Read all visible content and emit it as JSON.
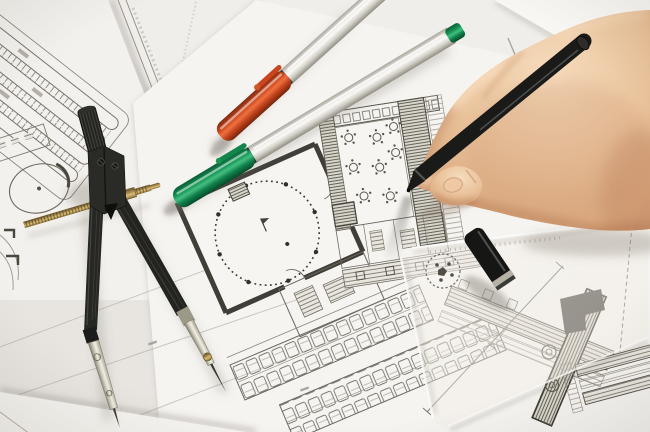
{
  "meta": {
    "domain": "photograph",
    "description": "Close-up photo of a hand drawing with a black pen on architectural floor plans; a drafting compass, an orange-capped and a green-capped marker pen, a black pen cap and a transparent set square lie on the drawings."
  },
  "objects": {
    "papers": {
      "label": "Stack of architectural drawings on white paper",
      "base_color": "#e8e5e1",
      "sheet_colors": [
        "#f0eeea",
        "#f3f1ed",
        "#f6f4f1",
        "#f8f7f4"
      ],
      "line_color": "#57544c",
      "wall_color": "#413e38"
    },
    "site_plan": {
      "label": "Site plan with rows of parking stalls (top left)"
    },
    "floor_plan": {
      "label": "Floor plan with dotted round hall, table seating area, hatched walls and parking rows"
    },
    "compass": {
      "label": "Drafting compass with knurled handle and brass adjusting screw",
      "body_color": "#262624",
      "metal_color": "#d8d5c6",
      "brass_color": "#b89a58"
    },
    "orange_pen": {
      "label": "Silver marker pen with orange cap",
      "cap_color": "#d34e22",
      "body_color": "#e9e7e1"
    },
    "green_pen": {
      "label": "Silver marker pen with green cap and green end plug",
      "cap_color": "#189a58",
      "body_color": "#e9e7e1"
    },
    "black_pen": {
      "label": "Black pen held in the hand",
      "color": "#1a1a18"
    },
    "pen_cap": {
      "label": "Black pen cap with metal ring lying on the set square",
      "color": "#161614",
      "ring_color": "#b5b1a5"
    },
    "set_square": {
      "label": "Transparent set square with round maker's mark",
      "tint": "rgba(242,238,228,0.34)"
    },
    "hand": {
      "label": "Right hand writing with a black pen",
      "skin_light": "#f6dcbd",
      "skin_mid": "#eac49d",
      "skin_shadow": "#c99570"
    }
  }
}
